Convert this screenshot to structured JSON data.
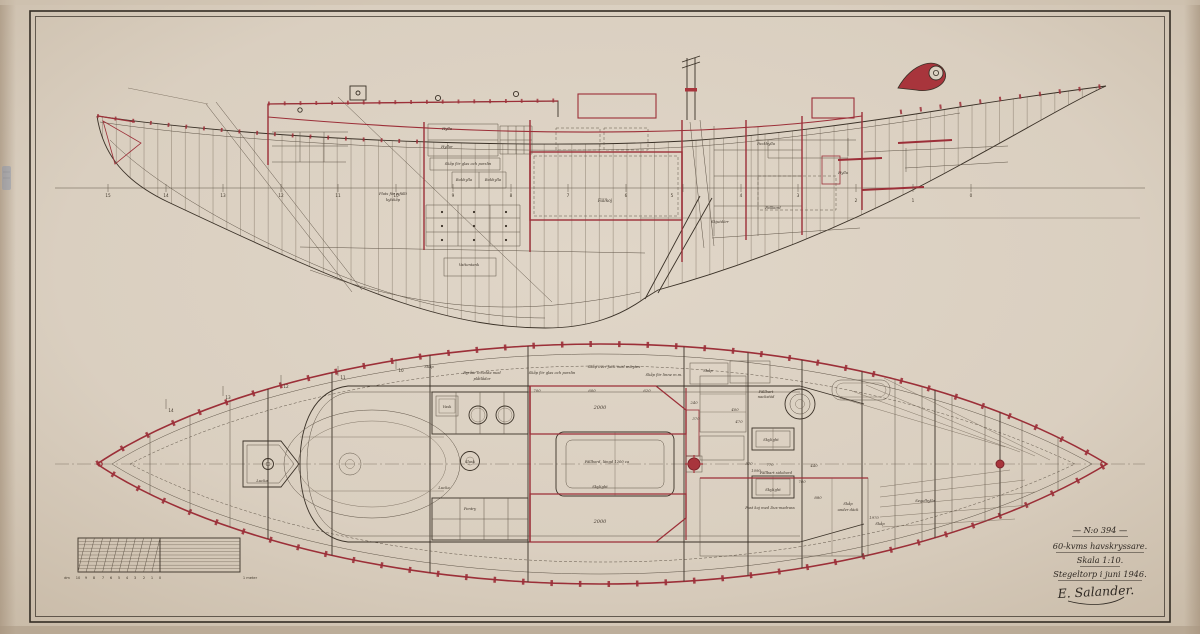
{
  "title_block": {
    "drawing_number": "— N:o 394 —",
    "vessel_type": "60-kvms havskryssare.",
    "scale": "Skala 1:10.",
    "place_date": "Stegeltorp i juni 1946.",
    "signature": "E. Salander."
  },
  "profile_view": {
    "labels": {
      "hylla_fwd": "Hylla",
      "hyllor": "Hyllor",
      "glas_porslin": "Skåp för glas och porslin",
      "bokhylla_a": "Bokhylla",
      "bokhylla_b": "Bokhylla",
      "kylskap_line1": "Plats för infällt",
      "kylskap_line2": "kylskåp",
      "fallkoj": "Fällkoj",
      "vattentank": "Vattentank",
      "packhylla": "Packhylla",
      "fallbord": "Fällbord",
      "skjutdorr": "Skjutdörr",
      "hylla_aft": "Hylla"
    },
    "stations": [
      "15",
      "14",
      "13",
      "12",
      "11",
      "10",
      "9",
      "8",
      "7",
      "6",
      "5",
      "4",
      "3",
      "2",
      "1",
      "0"
    ]
  },
  "plan_view": {
    "labels": {
      "skap_fwd": "Skåp",
      "byraar_line1": "Byråar inredda med",
      "byraar_line2": "plåtlådor",
      "skap_glas": "Skåp för glas och porslin",
      "skap_fack": "Skåp över fack med avbytes",
      "skap_linne": "Skåp för linne m.m.",
      "lucka_bow": "Lucka",
      "lucka_pentry": "Lucka",
      "vask": "Vask",
      "slask": "Slask",
      "pentry": "Pentry",
      "fallbord": "Fällbord, längd 1200 ca",
      "skylight_salon": "Skylight",
      "skylight_aft1": "Skylight",
      "skylight_aft2": "Skylight",
      "nackstod_line1": "Fällbart",
      "nackstod_line2": "nackstöd",
      "sidobord": "Fällbart sidobord",
      "dux_koj": "Fast koj med Dux-madrass",
      "skap_side": "Skåp",
      "skap_under_line1": "Skåp",
      "skap_under_line2": "under däck",
      "segelhylla": "Segelhylla",
      "skap_aft": "Skåp"
    },
    "dimensions": {
      "d700": "700",
      "d600": "600",
      "d620": "620",
      "d240": "240",
      "koj_upper": "2000",
      "koj_lower": "2000",
      "d370": "370",
      "d400": "400",
      "d470": "470",
      "d570": "570",
      "d770": "770",
      "d1090": "1090",
      "d780": "780",
      "d440": "440",
      "d880": "880",
      "d1970": "1970"
    },
    "stations": [
      "14",
      "13",
      "12",
      "11",
      "10"
    ]
  },
  "scale_bar": {
    "unit": "dm",
    "numbers": [
      "10",
      "9",
      "8",
      "7",
      "6",
      "5",
      "4",
      "3",
      "2",
      "1",
      "0"
    ],
    "meter_label": "1 meter"
  }
}
